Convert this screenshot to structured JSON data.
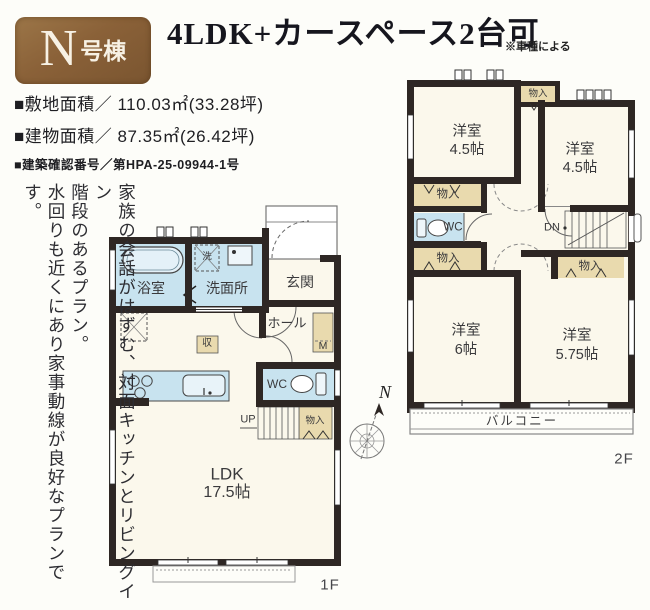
{
  "badge": {
    "letter": "N",
    "suffix": "号棟"
  },
  "header": {
    "title": "4LDK+カースペース2台可",
    "note": "※車種による",
    "site_area": "■敷地面積／ 110.03㎡(33.28坪)",
    "building_area": "■建物面積／ 87.35㎡(26.42坪)",
    "confirmation": "■建築確認番号／第HPA-25-09944-1号"
  },
  "description": {
    "line1": "家族の会話がはずむ、対面キッチンとリビングイン",
    "line2": "階段のあるプラン。",
    "line3": "水回りも近くにあり家事動線が良好なプランです。"
  },
  "compass": {
    "north": "N"
  },
  "floor1": {
    "label": "1F",
    "bath": "浴室",
    "laundry": "洗",
    "washroom": "洗面所",
    "entrance": "玄関",
    "hall": "ホール",
    "meter": "M",
    "storage": "収",
    "wc": "WC",
    "up": "UP",
    "closet": "物入",
    "ldk_name": "LDK",
    "ldk_size": "17.5帖"
  },
  "floor2": {
    "label": "2F",
    "closet_top": "物入",
    "room1_name": "洋室",
    "room1_size": "4.5帖",
    "room2_name": "洋室",
    "room2_size": "4.5帖",
    "closet_b": "物入",
    "wc": "WC",
    "closet_c": "物入",
    "dn": "DN",
    "closet_d": "物入",
    "room3_name": "洋室",
    "room3_size": "6帖",
    "room4_name": "洋室",
    "room4_size": "5.75帖",
    "balcony": "バルコニー"
  },
  "colors": {
    "wall": "#2e2724",
    "wet_area": "#c8e3ef",
    "closet_fill": "#e9daae",
    "room_fill": "#fbf8ec",
    "badge_brown": "#8a6138"
  }
}
